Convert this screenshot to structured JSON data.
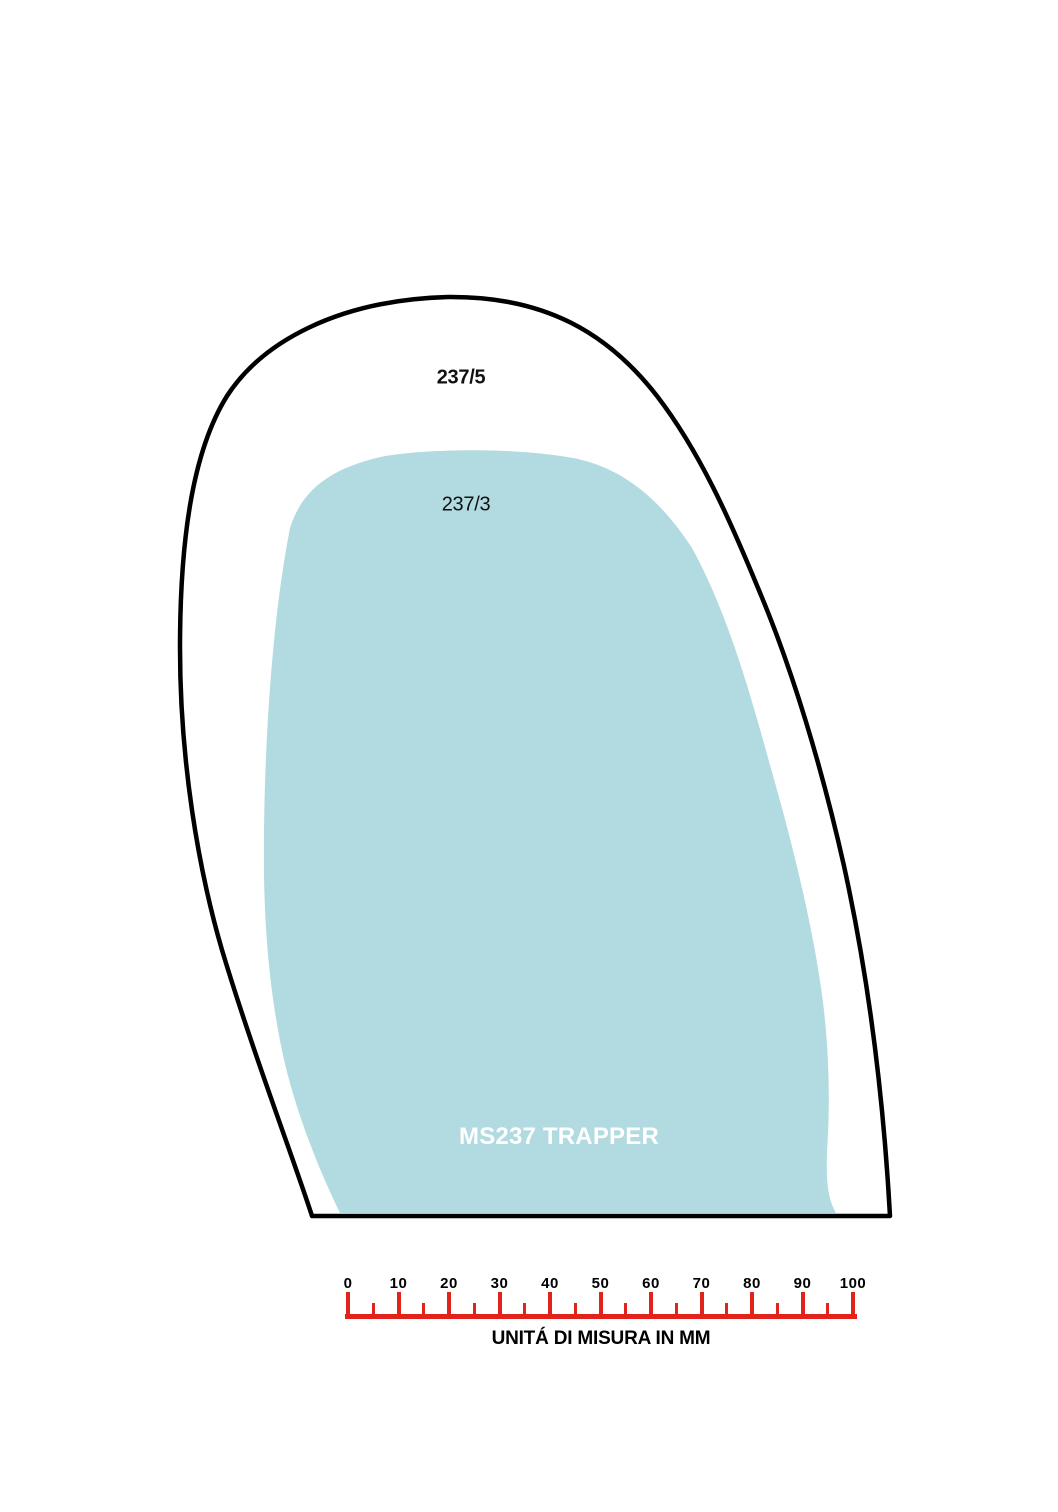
{
  "diagram": {
    "outer_label": "237/5",
    "inner_label": "237/3",
    "model_label": "MS237 TRAPPER",
    "outline_color": "#000000",
    "fill_color": "#b2dbe1",
    "model_label_color": "#ffffff"
  },
  "ruler": {
    "color": "#e2231c",
    "unit_min": 0,
    "unit_max": 100,
    "major_step": 10,
    "minor_step": 5,
    "labels": [
      "0",
      "10",
      "20",
      "30",
      "40",
      "50",
      "60",
      "70",
      "80",
      "90",
      "100"
    ],
    "caption": "UNITÁ DI MISURA IN MM"
  }
}
